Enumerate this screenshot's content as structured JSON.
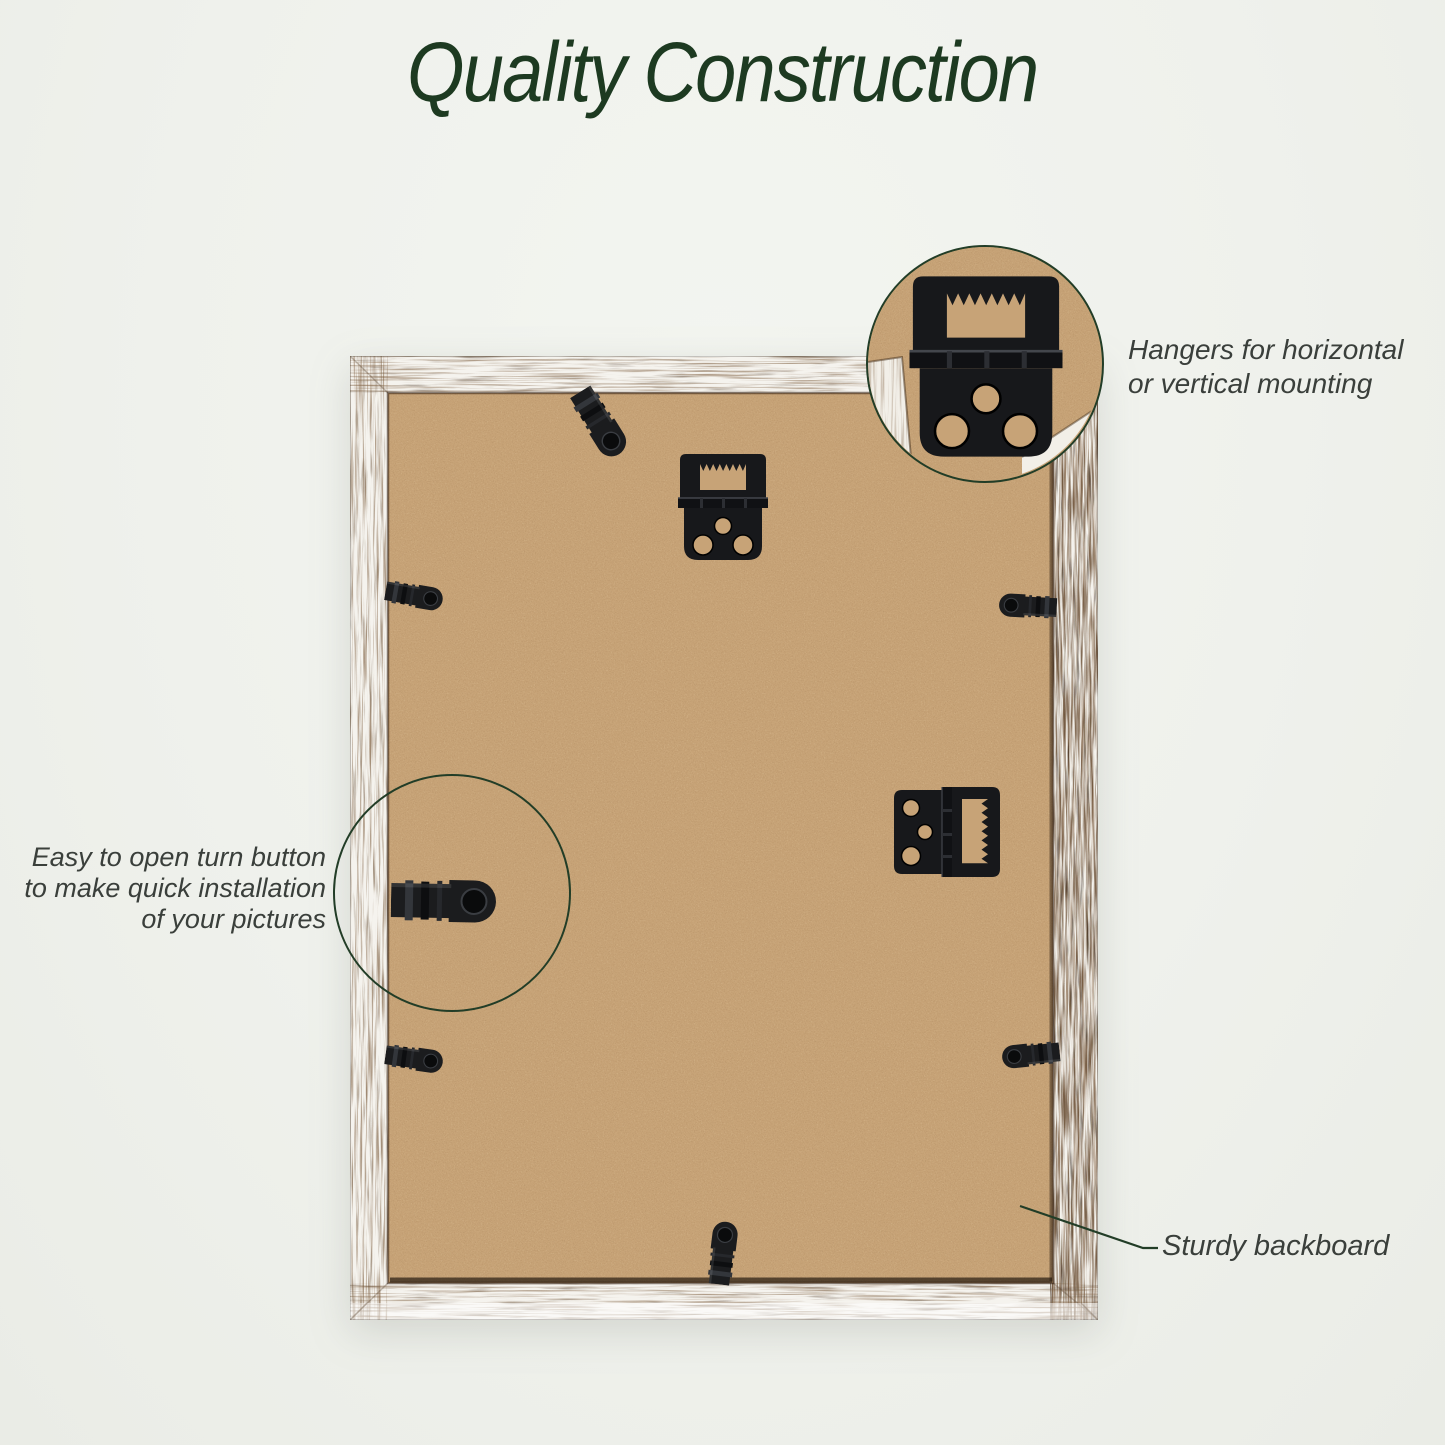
{
  "title": "Quality Construction",
  "annotations": {
    "hangers": {
      "lines": [
        "Hangers for horizontal",
        "or vertical mounting"
      ]
    },
    "turn_button": {
      "lines": [
        "Easy to open turn button",
        "to make quick installation",
        "of your pictures"
      ]
    },
    "backboard": {
      "label": "Sturdy backboard"
    }
  },
  "hardware": {
    "items": [
      "sawtooth hanger (top, portrait hanging)",
      "sawtooth hanger (side, landscape hanging)",
      "turn buttons (7)"
    ]
  },
  "colors": {
    "background": "#eff1ec",
    "title_green": "#1d3a21",
    "annotation_text": "#3a3f3b",
    "callout_line_green": "#223d27",
    "backboard_tan": "#c7a377",
    "frame_white": "#f5f3ee",
    "hardware_black": "#17181b"
  }
}
